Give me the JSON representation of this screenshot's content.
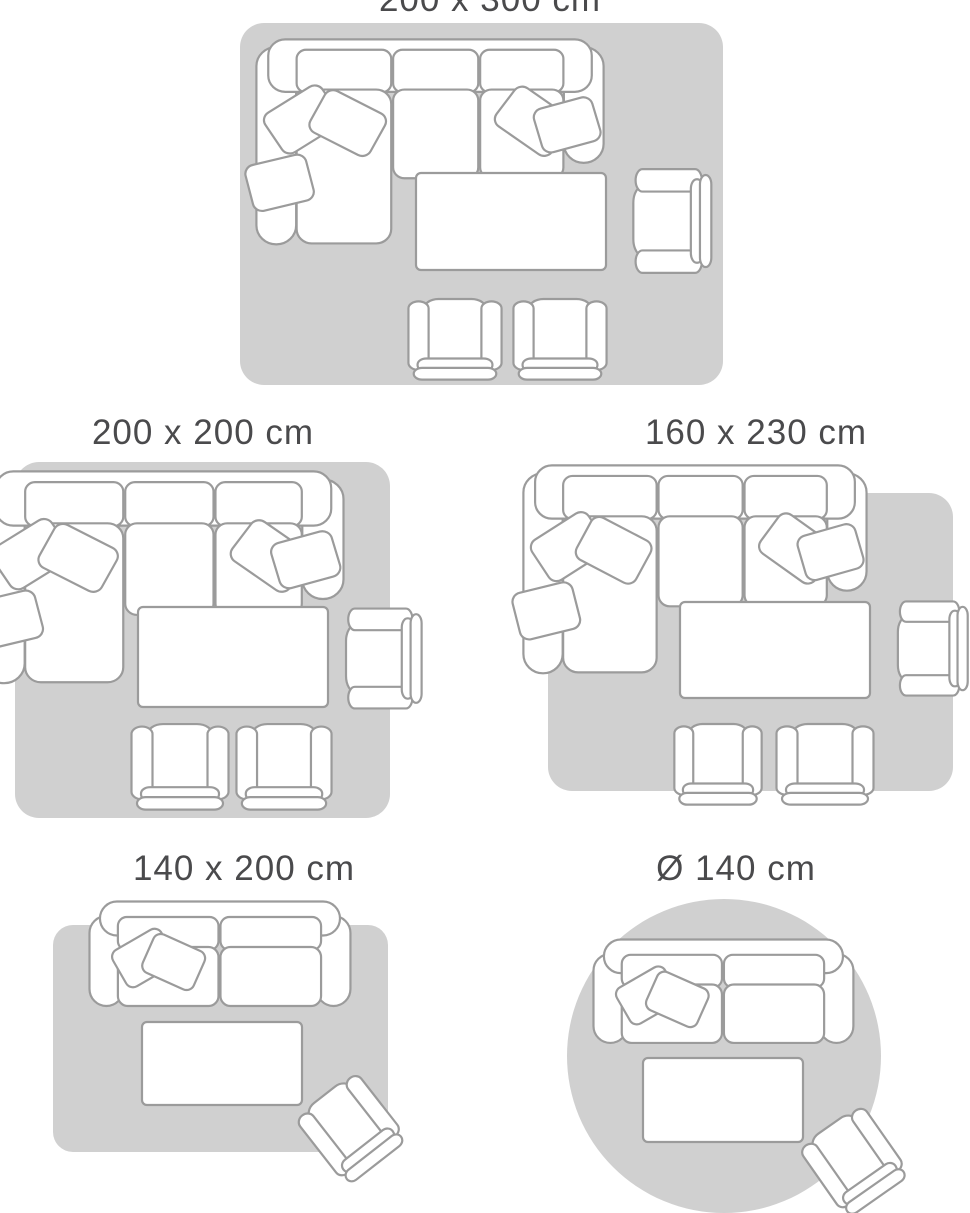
{
  "colors": {
    "background": "#ffffff",
    "rug": "#d0d0d0",
    "furniture-fill": "#ffffff",
    "furniture-outline": "#9b9b9b",
    "label-text": "#4a4a4c"
  },
  "size_guide": {
    "description": "Rug size guide with top-view living room furniture layouts",
    "diagrams": [
      {
        "label": "200 x 300 cm",
        "shape": "rectangle",
        "furniture": [
          "corner-sofa",
          "coffee-table",
          "armchair",
          "armchair",
          "armchair"
        ]
      },
      {
        "label": "200 x 200 cm",
        "shape": "rectangle",
        "furniture": [
          "corner-sofa",
          "coffee-table",
          "armchair",
          "armchair",
          "armchair"
        ]
      },
      {
        "label": "160 x 230 cm",
        "shape": "rectangle",
        "furniture": [
          "corner-sofa",
          "coffee-table",
          "armchair",
          "armchair",
          "armchair"
        ]
      },
      {
        "label": "140 x 200 cm",
        "shape": "rectangle",
        "furniture": [
          "loveseat-sofa",
          "coffee-table",
          "armchair"
        ]
      },
      {
        "label": "Ø 140 cm",
        "shape": "circle",
        "furniture": [
          "loveseat-sofa",
          "coffee-table",
          "armchair"
        ]
      }
    ]
  }
}
